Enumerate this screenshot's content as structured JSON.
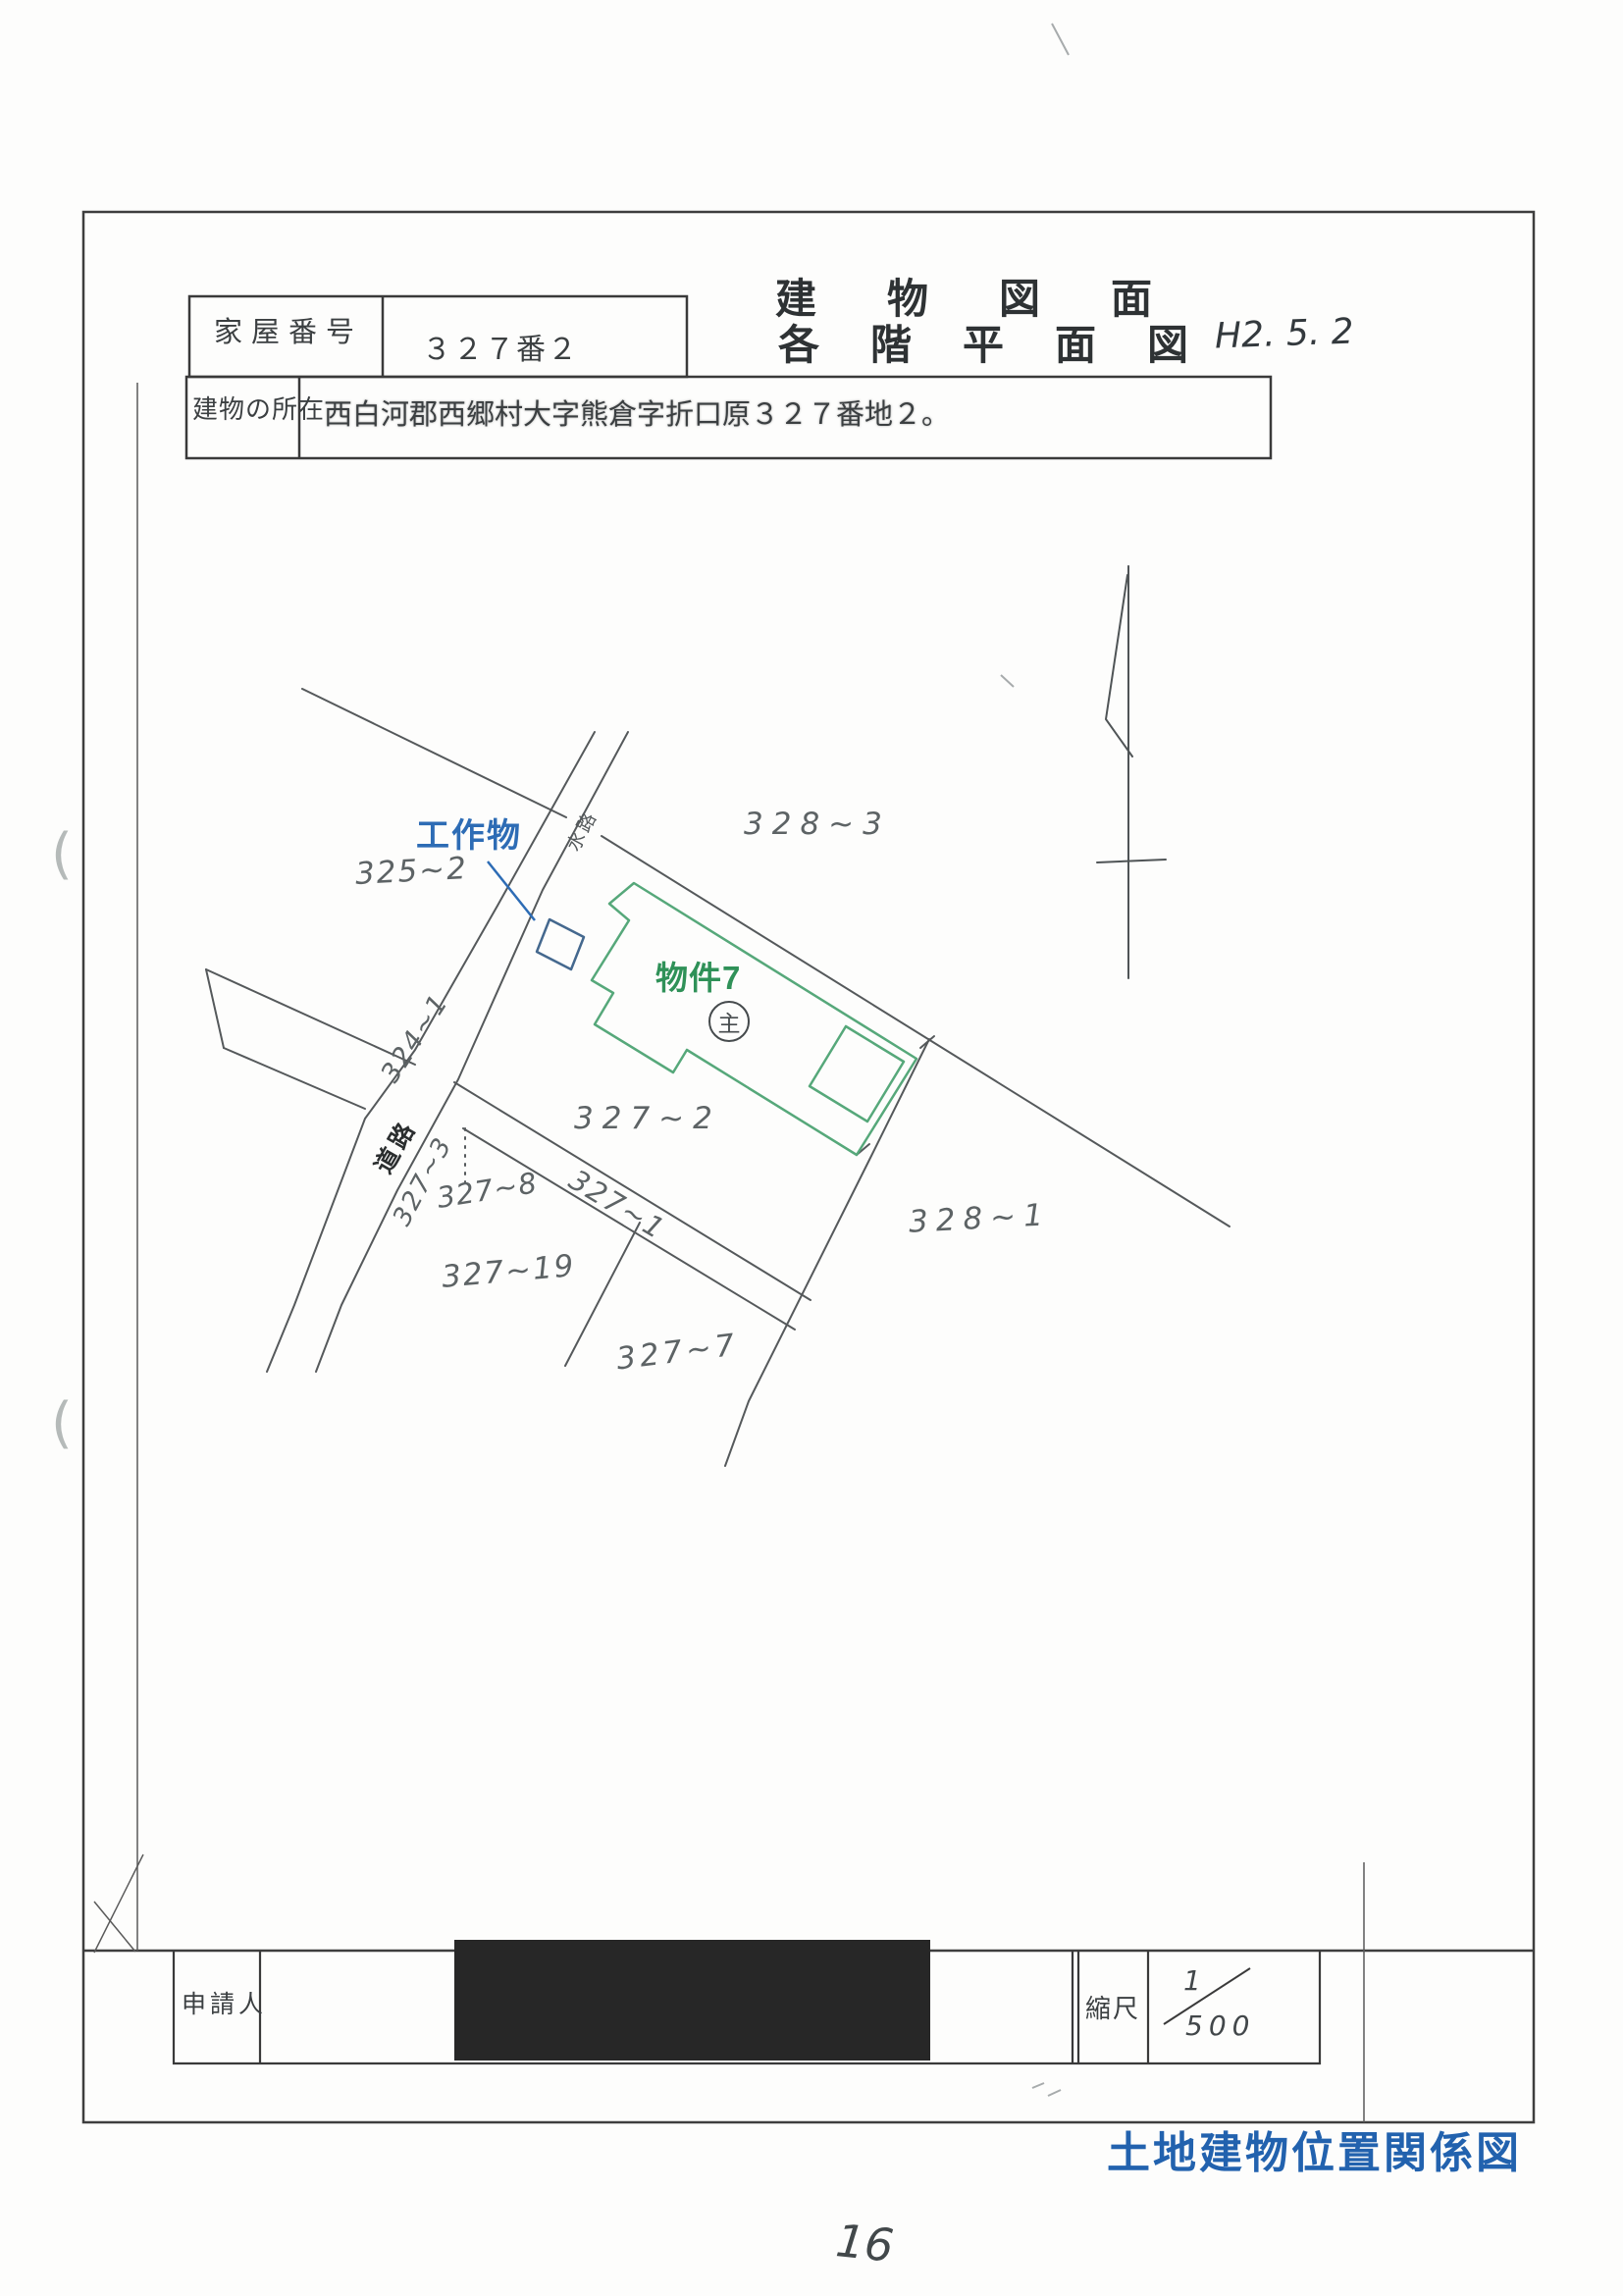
{
  "document": {
    "form": {
      "house_number_label": "家屋番号",
      "house_number_value": "３２７番２",
      "location_label": "建物の所在",
      "location_value": "西白河郡西郷村大字熊倉字折口原３２７番地２。"
    },
    "title": {
      "line1": "建物図面",
      "line2": "各階平面図",
      "handwritten_date": "H2. 5. 2"
    }
  },
  "map": {
    "structure_label": "工作物",
    "building_label": "物件7",
    "building_circle_mark": "主",
    "road_label": "道路",
    "waterway_label": "水路",
    "parcels": [
      "325~2",
      "328~3",
      "327~2",
      "324~1",
      "327~3",
      "327~8",
      "327~1",
      "327~19",
      "328~1",
      "327~7"
    ]
  },
  "footer_table": {
    "applicant_label": "申請人",
    "scale_label": "縮尺",
    "scale_numerator": "1",
    "scale_denominator": "500"
  },
  "footer": {
    "map_type_caption": "土地建物位置関係図",
    "page_number": "16"
  },
  "colors": {
    "annotation_blue": "#2d6cb5",
    "building_green": "#2f9158",
    "caption_blue": "#2262ae",
    "line_gray": "#55595b"
  }
}
